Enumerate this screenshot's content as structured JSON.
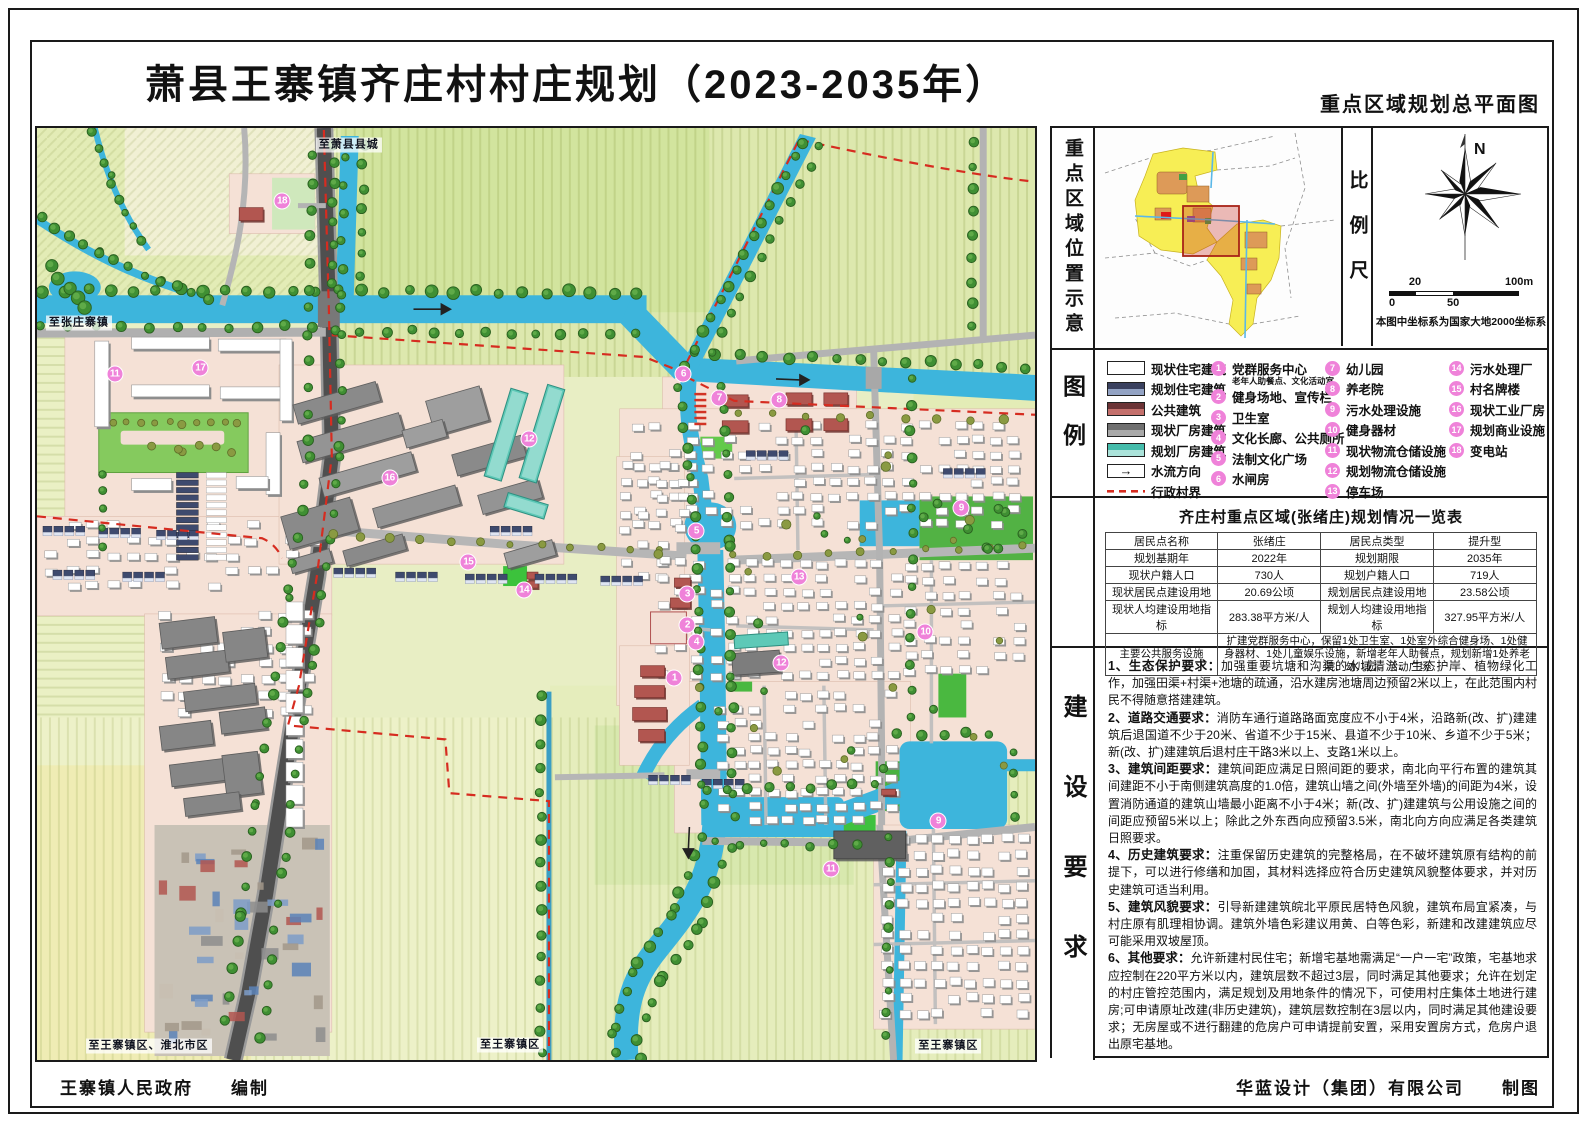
{
  "header": {
    "title": "萧县王寨镇齐庄村村庄规划（2023-2035年）",
    "subtitle": "重点区域规划总平面图"
  },
  "panel": {
    "section1_label": "重点区域位置示意",
    "scale_label": "比例尺",
    "compass_n": "N",
    "scale": {
      "t20": "20",
      "t100": "100m",
      "t0": "0",
      "t50": "50",
      "note": "本图中坐标系为国家大地2000坐标系"
    },
    "legend_label": "图例",
    "legend_flow_arrow": "→",
    "legend_swatches": [
      {
        "label": "现状住宅建筑",
        "type": "white"
      },
      {
        "label": "规划住宅建筑",
        "type": "navy"
      },
      {
        "label": "公共建筑",
        "type": "red"
      },
      {
        "label": "现状厂房建筑",
        "type": "gray"
      },
      {
        "label": "规划厂房建筑",
        "type": "teal"
      },
      {
        "label": "水流方向",
        "type": "flow"
      },
      {
        "label": "行政村界",
        "type": "boundary"
      }
    ],
    "legend_points": [
      {
        "n": "1",
        "label": "党群服务中心",
        "sub": "老年人助餐点、文化活动室"
      },
      {
        "n": "2",
        "label": "健身场地、宣传栏"
      },
      {
        "n": "3",
        "label": "卫生室"
      },
      {
        "n": "4",
        "label": "文化长廊、公共厕所"
      },
      {
        "n": "5",
        "label": "法制文化广场"
      },
      {
        "n": "6",
        "label": "水闸房"
      },
      {
        "n": "7",
        "label": "幼儿园"
      },
      {
        "n": "8",
        "label": "养老院"
      },
      {
        "n": "9",
        "label": "污水处理设施"
      },
      {
        "n": "10",
        "label": "健身器材"
      },
      {
        "n": "11",
        "label": "现状物流仓储设施"
      },
      {
        "n": "12",
        "label": "规划物流仓储设施"
      },
      {
        "n": "13",
        "label": "停车场"
      },
      {
        "n": "14",
        "label": "污水处理厂"
      },
      {
        "n": "15",
        "label": "村名牌楼"
      },
      {
        "n": "16",
        "label": "现状工业厂房"
      },
      {
        "n": "17",
        "label": "规划商业设施"
      },
      {
        "n": "18",
        "label": "变电站"
      }
    ],
    "table": {
      "title": "齐庄村重点区域(张绪庄)规划情况一览表",
      "rows": [
        [
          "居民点名称",
          "张绪庄",
          "居民点类型",
          "提升型"
        ],
        [
          "规划基期年",
          "2022年",
          "规划期限",
          "2035年"
        ],
        [
          "现状户籍人口",
          "730人",
          "规划户籍人口",
          "719人"
        ],
        [
          "现状居民点建设用地",
          "20.69公顷",
          "规划居民点建设用地",
          "23.58公顷"
        ],
        [
          "现状人均建设用地指标",
          "283.38平方米/人",
          "规划人均建设用地指标",
          "327.95平方米/人"
        ]
      ],
      "last_row": [
        "主要公共服务设施",
        "扩建党群服务中心，保留1处卫生室、1处室外综合健身场、1处健身器材、1处儿童娱乐设施，新增老年人助餐点，规划新增1处养老院、幼儿园、活动广场"
      ]
    },
    "req_label": "建设要求",
    "requirements": [
      {
        "head": "1、生态保护要求：",
        "body": "加强重要坑塘和沟渠的水域清淤、生态护岸、植物绿化工作，加强田渠+村渠+池塘的疏通，沿水建房池塘周边预留2米以上，在此范围内村民不得随意搭建建筑。"
      },
      {
        "head": "2、道路交通要求：",
        "body": "消防车通行道路路面宽度应不小于4米，沿路新(改、扩)建建筑后退国道不少于20米、省道不少于15米、县道不少于10米、乡道不少于5米；新(改、扩)建建筑后退村庄干路3米以上、支路1米以上。"
      },
      {
        "head": "3、建筑间距要求：",
        "body": "建筑间距应满足日照间距的要求，南北向平行布置的建筑其间建距不小于南侧建筑高度的1.0倍，建筑山墙之间(外墙至外墙)的间距为4米，设置消防通道的建筑山墙最小距离不小于4米；新(改、扩)建建筑与公用设施之间的间距应预留5米以上；除此之外东西向应预留3.5米，南北向方向应满足各类建筑日照要求。"
      },
      {
        "head": "4、历史建筑要求：",
        "body": "注重保留历史建筑的完整格局，在不破坏建筑原有结构的前提下，可以进行修缮和加固，其材料选择应符合历史建筑风貌整体要求，并对历史建筑可适当利用。"
      },
      {
        "head": "5、建筑风貌要求：",
        "body": "引导新建建筑皖北平原民居特色风貌，建筑布局宜紧凑，与村庄原有肌理相协调。建筑外墙色彩建议用黄、白等色彩，新建和改建建筑应尽可能采用双坡屋顶。"
      },
      {
        "head": "6、其他要求：",
        "body": "允许新建村民住宅；新增宅基地需满足“一户一宅”政策，宅基地求应控制在220平方米以内，建筑层数不超过3层，同时满足其他要求；允许在划定的村庄管控范围内，满足规划及用地条件的情况下，可使用村庄集体土地进行建房;可申请原址改建(非历史建筑)，建筑层数控制在3层以内，同时满足其他建设要求；无房屋或不进行翻建的危房户可申请提前安置，采用安置房方式，危房户退出原宅基地。"
      }
    ]
  },
  "map": {
    "labels": [
      {
        "text": "至萧县县城",
        "x": 313,
        "y": 17
      },
      {
        "text": "至张庄寨镇",
        "x": 42,
        "y": 196
      },
      {
        "text": "至王寨镇区、淮北市区",
        "x": 112,
        "y": 922
      },
      {
        "text": "至王寨镇区",
        "x": 475,
        "y": 921
      },
      {
        "text": "至王寨镇区",
        "x": 915,
        "y": 922
      }
    ],
    "markers": [
      {
        "n": "18",
        "x": 246,
        "y": 73
      },
      {
        "n": "11",
        "x": 78,
        "y": 247
      },
      {
        "n": "17",
        "x": 164,
        "y": 241
      },
      {
        "n": "12",
        "x": 494,
        "y": 312
      },
      {
        "n": "16",
        "x": 354,
        "y": 352
      },
      {
        "n": "15",
        "x": 433,
        "y": 436
      },
      {
        "n": "14",
        "x": 489,
        "y": 464
      },
      {
        "n": "6",
        "x": 649,
        "y": 247
      },
      {
        "n": "7",
        "x": 685,
        "y": 271
      },
      {
        "n": "8",
        "x": 745,
        "y": 273
      },
      {
        "n": "9",
        "x": 928,
        "y": 382
      },
      {
        "n": "5",
        "x": 662,
        "y": 405
      },
      {
        "n": "13",
        "x": 765,
        "y": 451
      },
      {
        "n": "3",
        "x": 653,
        "y": 468
      },
      {
        "n": "2",
        "x": 653,
        "y": 499
      },
      {
        "n": "4",
        "x": 662,
        "y": 516
      },
      {
        "n": "1",
        "x": 640,
        "y": 552
      },
      {
        "n": "12",
        "x": 747,
        "y": 537
      },
      {
        "n": "10",
        "x": 892,
        "y": 506
      },
      {
        "n": "9",
        "x": 905,
        "y": 696
      },
      {
        "n": "11",
        "x": 797,
        "y": 744
      }
    ]
  },
  "footer": {
    "left": "王寨镇人民政府　　编制",
    "right": "华蓝设计（集团）有限公司　　制图"
  },
  "colors": {
    "marker": "#ef82d9",
    "water": "#3db5dc",
    "boundary": "#d62c20",
    "road_dark": "#4f4f4f",
    "built_area": "#f5e1d6"
  }
}
